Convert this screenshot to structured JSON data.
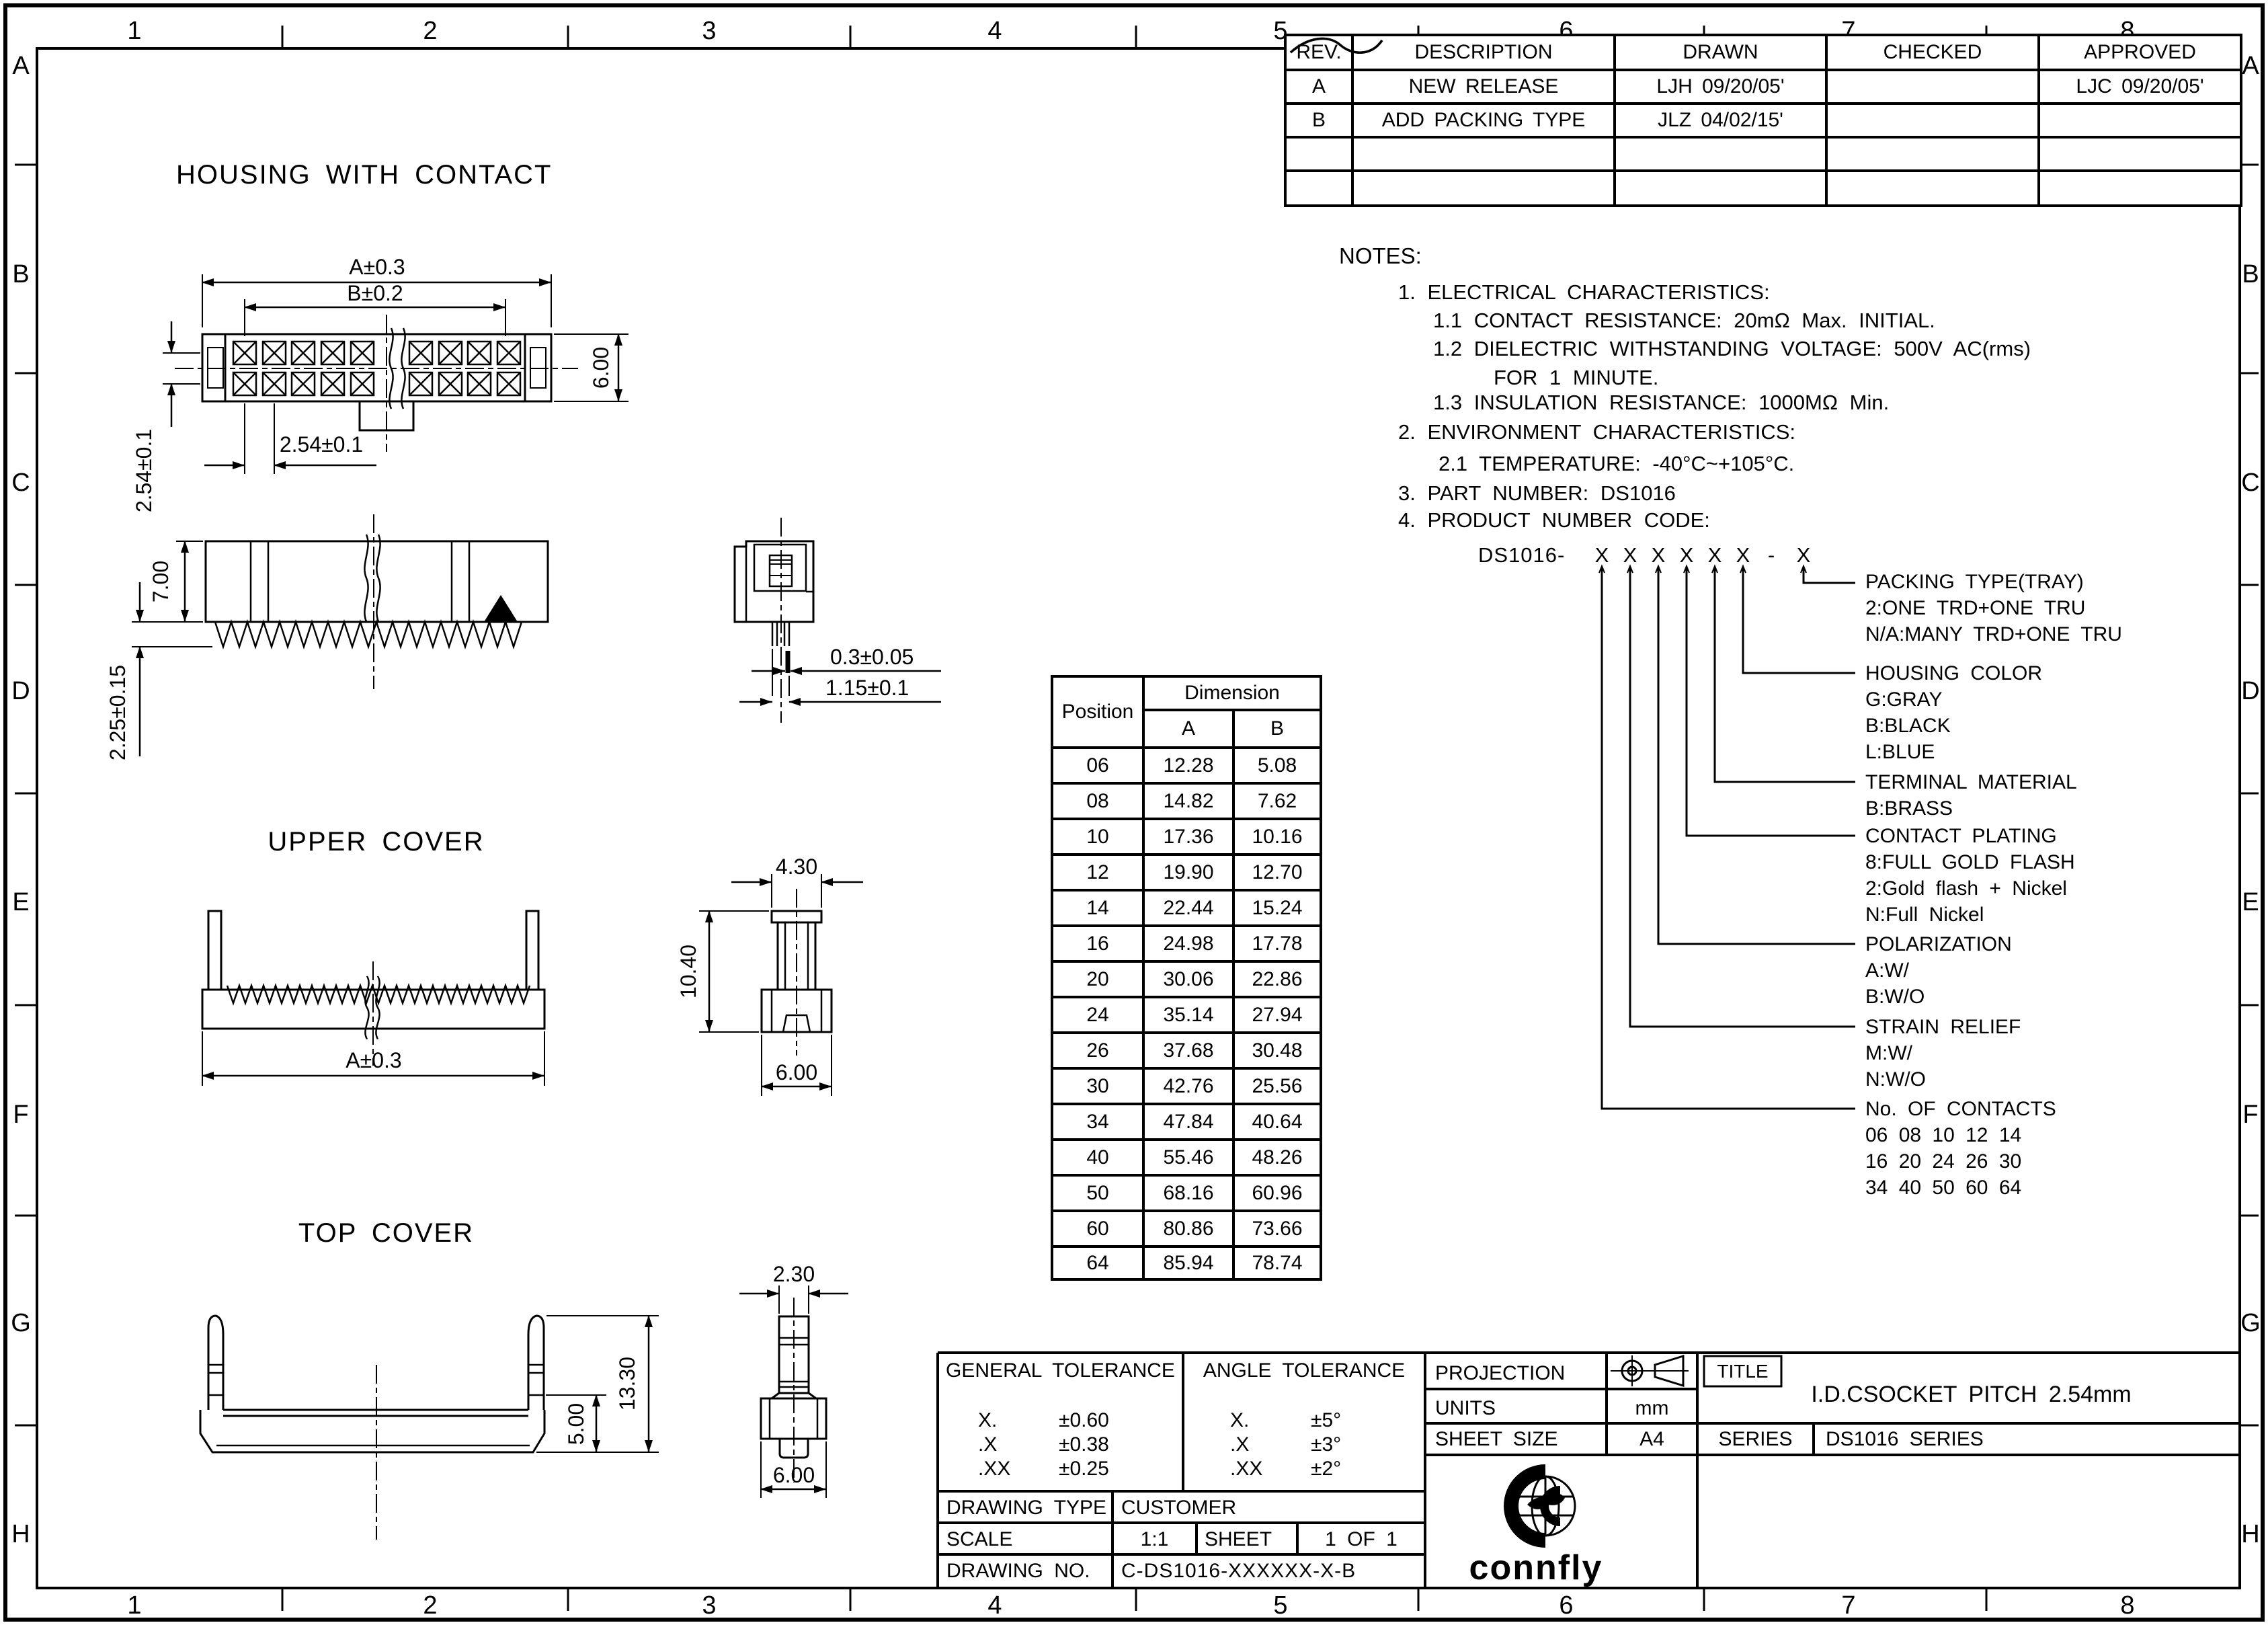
{
  "drawing": {
    "titles": {
      "housing": "HOUSING WITH CONTACT",
      "upper_cover": "UPPER COVER",
      "top_cover": "TOP COVER"
    }
  },
  "border": {
    "cols": [
      "1",
      "2",
      "3",
      "4",
      "5",
      "6",
      "7",
      "8"
    ],
    "rows": [
      "A",
      "B",
      "C",
      "D",
      "E",
      "F",
      "G",
      "H"
    ]
  },
  "revision_table": {
    "headers": [
      "REV.",
      "DESCRIPTION",
      "DRAWN",
      "CHECKED",
      "APPROVED"
    ],
    "rows": [
      {
        "rev": "A",
        "description": "NEW RELEASE",
        "drawn": "LJH 09/20/05'",
        "approved": "LJC 09/20/05'"
      },
      {
        "rev": "B",
        "description": "ADD PACKING TYPE",
        "drawn": "JLZ 04/02/15'",
        "approved": ""
      }
    ]
  },
  "notes": {
    "lines": [
      "NOTES:",
      "1. ELECTRICAL CHARACTERISTICS:",
      "1.1 CONTACT RESISTANCE: 20mΩ Max. INITIAL.",
      "1.2 DIELECTRIC WITHSTANDING VOLTAGE: 500V AC(rms)",
      "FOR 1 MINUTE.",
      "1.3 INSULATION RESISTANCE: 1000MΩ Min.",
      "2. ENVIRONMENT CHARACTERISTICS:",
      "2.1 TEMPERATURE: -40°C~+105°C.",
      "3. PART NUMBER: DS1016",
      "4. PRODUCT NUMBER CODE:"
    ]
  },
  "product_code": {
    "prefix": "DS1016-",
    "marks": [
      "X",
      "X",
      "X",
      "X",
      "X",
      "X",
      "-",
      "X"
    ],
    "legend": [
      {
        "title": "PACKING TYPE(TRAY)",
        "options": [
          "2:ONE TRD+ONE TRU",
          "N/A:MANY TRD+ONE TRU"
        ]
      },
      {
        "title": "HOUSING COLOR",
        "options": [
          "G:GRAY",
          "B:BLACK",
          "L:BLUE"
        ]
      },
      {
        "title": "TERMINAL MATERIAL",
        "options": [
          "B:BRASS"
        ]
      },
      {
        "title": "CONTACT PLATING",
        "options": [
          "8:FULL GOLD FLASH",
          "2:Gold flash + Nickel",
          "N:Full Nickel"
        ]
      },
      {
        "title": "POLARIZATION",
        "options": [
          "A:W/",
          "B:W/O"
        ]
      },
      {
        "title": "STRAIN RELIEF",
        "options": [
          "M:W/",
          "N:W/O"
        ]
      },
      {
        "title": "No. OF CONTACTS",
        "options": [
          "06 08 10 12 14",
          "16 20 24 26 30",
          "34 40 50 60 64"
        ]
      }
    ]
  },
  "dimension_table": {
    "position_header": "Position",
    "dimension_header": "Dimension",
    "col_a": "A",
    "col_b": "B",
    "rows": [
      {
        "pos": "06",
        "a": "12.28",
        "b": "5.08"
      },
      {
        "pos": "08",
        "a": "14.82",
        "b": "7.62"
      },
      {
        "pos": "10",
        "a": "17.36",
        "b": "10.16"
      },
      {
        "pos": "12",
        "a": "19.90",
        "b": "12.70"
      },
      {
        "pos": "14",
        "a": "22.44",
        "b": "15.24"
      },
      {
        "pos": "16",
        "a": "24.98",
        "b": "17.78"
      },
      {
        "pos": "20",
        "a": "30.06",
        "b": "22.86"
      },
      {
        "pos": "24",
        "a": "35.14",
        "b": "27.94"
      },
      {
        "pos": "26",
        "a": "37.68",
        "b": "30.48"
      },
      {
        "pos": "30",
        "a": "42.76",
        "b": "25.56"
      },
      {
        "pos": "34",
        "a": "47.84",
        "b": "40.64"
      },
      {
        "pos": "40",
        "a": "55.46",
        "b": "48.26"
      },
      {
        "pos": "50",
        "a": "68.16",
        "b": "60.96"
      },
      {
        "pos": "60",
        "a": "80.86",
        "b": "73.66"
      },
      {
        "pos": "64",
        "a": "85.94",
        "b": "78.74"
      }
    ]
  },
  "dims": {
    "housing_a": "A±0.3",
    "housing_b": "B±0.2",
    "housing_h": "6.00",
    "housing_pitch_row": "2.54±0.1",
    "housing_pitch_col": "2.54±0.1",
    "front_h": "7.00",
    "pin_len": "2.25±0.15",
    "pin_t": "0.3±0.05",
    "pin_w": "1.15±0.1",
    "uc_a": "A±0.3",
    "uc_top": "4.30",
    "uc_h": "10.40",
    "uc_bot": "6.00",
    "tc_h": "13.30",
    "tc_base": "5.00",
    "tc_top": "2.30",
    "tc_bot": "6.00"
  },
  "title_block": {
    "general_tolerance": {
      "title": "GENERAL TOLERANCE",
      "rows": [
        {
          "k": "X.",
          "v": "±0.60"
        },
        {
          "k": ".X",
          "v": "±0.38"
        },
        {
          "k": ".XX",
          "v": "±0.25"
        }
      ]
    },
    "angle_tolerance": {
      "title": "ANGLE TOLERANCE",
      "rows": [
        {
          "k": "X.",
          "v": "±5°"
        },
        {
          "k": ".X",
          "v": "±3°"
        },
        {
          "k": ".XX",
          "v": "±2°"
        }
      ]
    },
    "projection_label": "PROJECTION",
    "units_label": "UNITS",
    "units_value": "mm",
    "sheet_size_label": "SHEET SIZE",
    "sheet_size_value": "A4",
    "title_label": "TITLE",
    "title_value": "I.D.CSOCKET PITCH 2.54mm",
    "series_label": "SERIES",
    "series_value": "DS1016 SERIES",
    "drawing_type_label": "DRAWING TYPE",
    "drawing_type_value": "CUSTOMER",
    "scale_label": "SCALE",
    "scale_value": "1:1",
    "sheet_label": "SHEET",
    "sheet_value": "1 OF 1",
    "drawing_no_label": "DRAWING NO.",
    "drawing_no_value": "C-DS1016-XXXXXX-X-B",
    "logo_text": "connfly"
  }
}
